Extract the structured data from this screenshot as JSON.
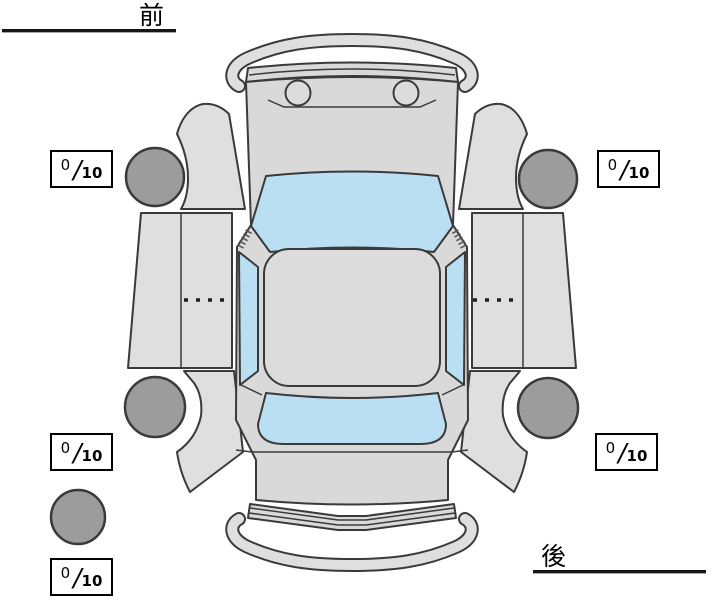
{
  "app": {
    "name": "vehicle-condition-tire-diagram"
  },
  "labels": {
    "front": "前",
    "rear": "後"
  },
  "scores": {
    "slash": "/",
    "denominator": "10",
    "items": [
      {
        "id": "front-left",
        "value": "0"
      },
      {
        "id": "front-right",
        "value": "0"
      },
      {
        "id": "rear-left",
        "value": "0"
      },
      {
        "id": "rear-right",
        "value": "0"
      },
      {
        "id": "spare",
        "value": "0"
      }
    ]
  },
  "diagram": {
    "view": "car-top-view",
    "tires": [
      "front-left",
      "front-right",
      "rear-left",
      "rear-right",
      "spare"
    ]
  },
  "colors": {
    "bg": "#ffffff",
    "body": "#d9d9d9",
    "panel": "#dfdfdf",
    "roof": "#dcdcdc",
    "glass": "#badff2",
    "tire": "#9c9c9c",
    "outline": "#3a3a3a",
    "box-border": "#000000",
    "text": "#000000"
  }
}
